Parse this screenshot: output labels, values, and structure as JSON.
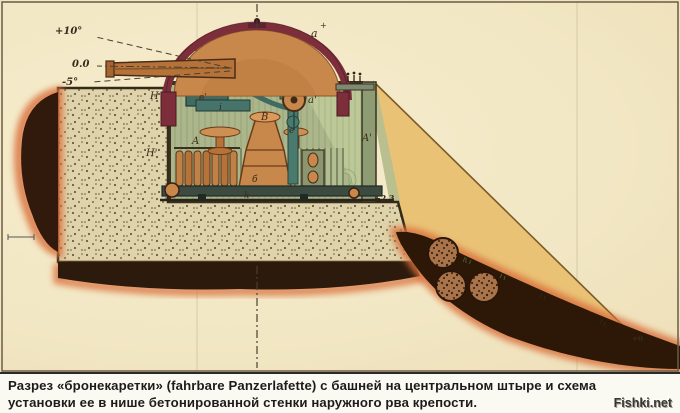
{
  "caption": {
    "line1": "Разрез «бронекаретки» (fahrbare Panzerlafette) с башней на центральном штыре и схема",
    "line2": "установки ее в нише бетонированной стенки наружного рва крепости.",
    "watermark": "Fishki.net"
  },
  "labels": {
    "elevation_up": "+10°",
    "elevation_zero": "0.0",
    "elevation_down": "-5°",
    "wall_upper": "Н",
    "wall_lower": "Н'",
    "rack_left": "A",
    "rack_right": "A'",
    "breech": "в'",
    "breech_link": "i",
    "column": "В",
    "pedestal": "б",
    "base_truck": "k",
    "stand": "e",
    "dome": "a",
    "handwheel": "a'",
    "level_floor": "+2.3",
    "level_ditch": "+0"
  },
  "colors": {
    "paper": "#f2e7c4",
    "concrete": "#ded3aa",
    "armor": "#7d2e3b",
    "dome": "#c8884c",
    "room_green": "#a9b488",
    "machinery_teal": "#4a7a6e",
    "slope_yellow": "#e9c276",
    "earth_dark": "#2d1808",
    "earth_glow": "#d9713c",
    "caption_text": "#1c1c1c"
  }
}
